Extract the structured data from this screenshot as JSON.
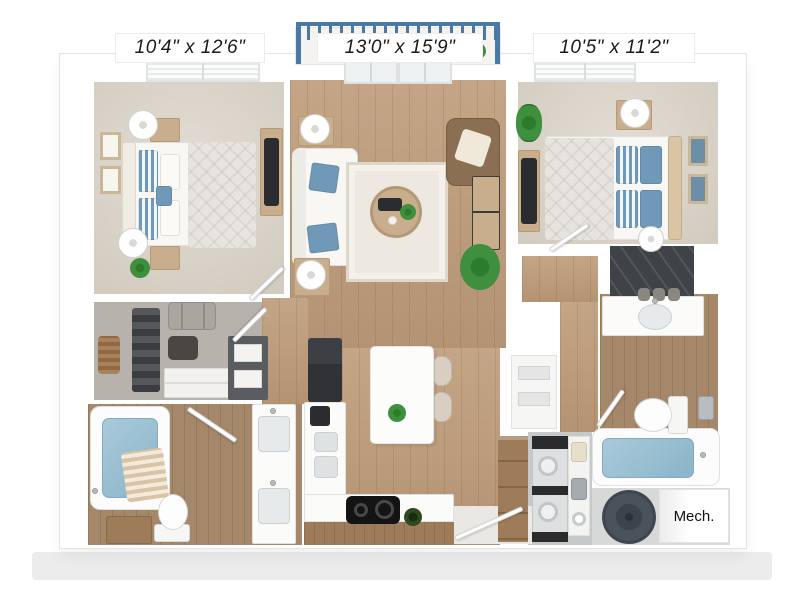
{
  "floorplan": {
    "dimension_labels": {
      "bedroom_left": "10'4\" x 12'6\"",
      "living_room": "13'0\" x 15'9\"",
      "bedroom_right": "10'5\" x 11'2\""
    },
    "room_labels": {
      "mech": "Mech."
    },
    "colors": {
      "label_ink": "#1a1a1a",
      "accent_blue": "#4a7aa4",
      "water_blue": "#8ab4c9",
      "pillow_blue": "#7099b8",
      "floor_wood": "#bd9b79",
      "floor_wood_dark": "#a5876a",
      "carpet": "#d8d1c5",
      "closet_carpet": "#b7b3ac",
      "furniture_wood": "#c9ae8e",
      "cabinet_wood": "#9e7c59",
      "appliance_dark": "#2b2c30",
      "chair_brown": "#8a6f53",
      "plant_green": "#3e8f3e",
      "shadow_band": "#ececec"
    }
  }
}
